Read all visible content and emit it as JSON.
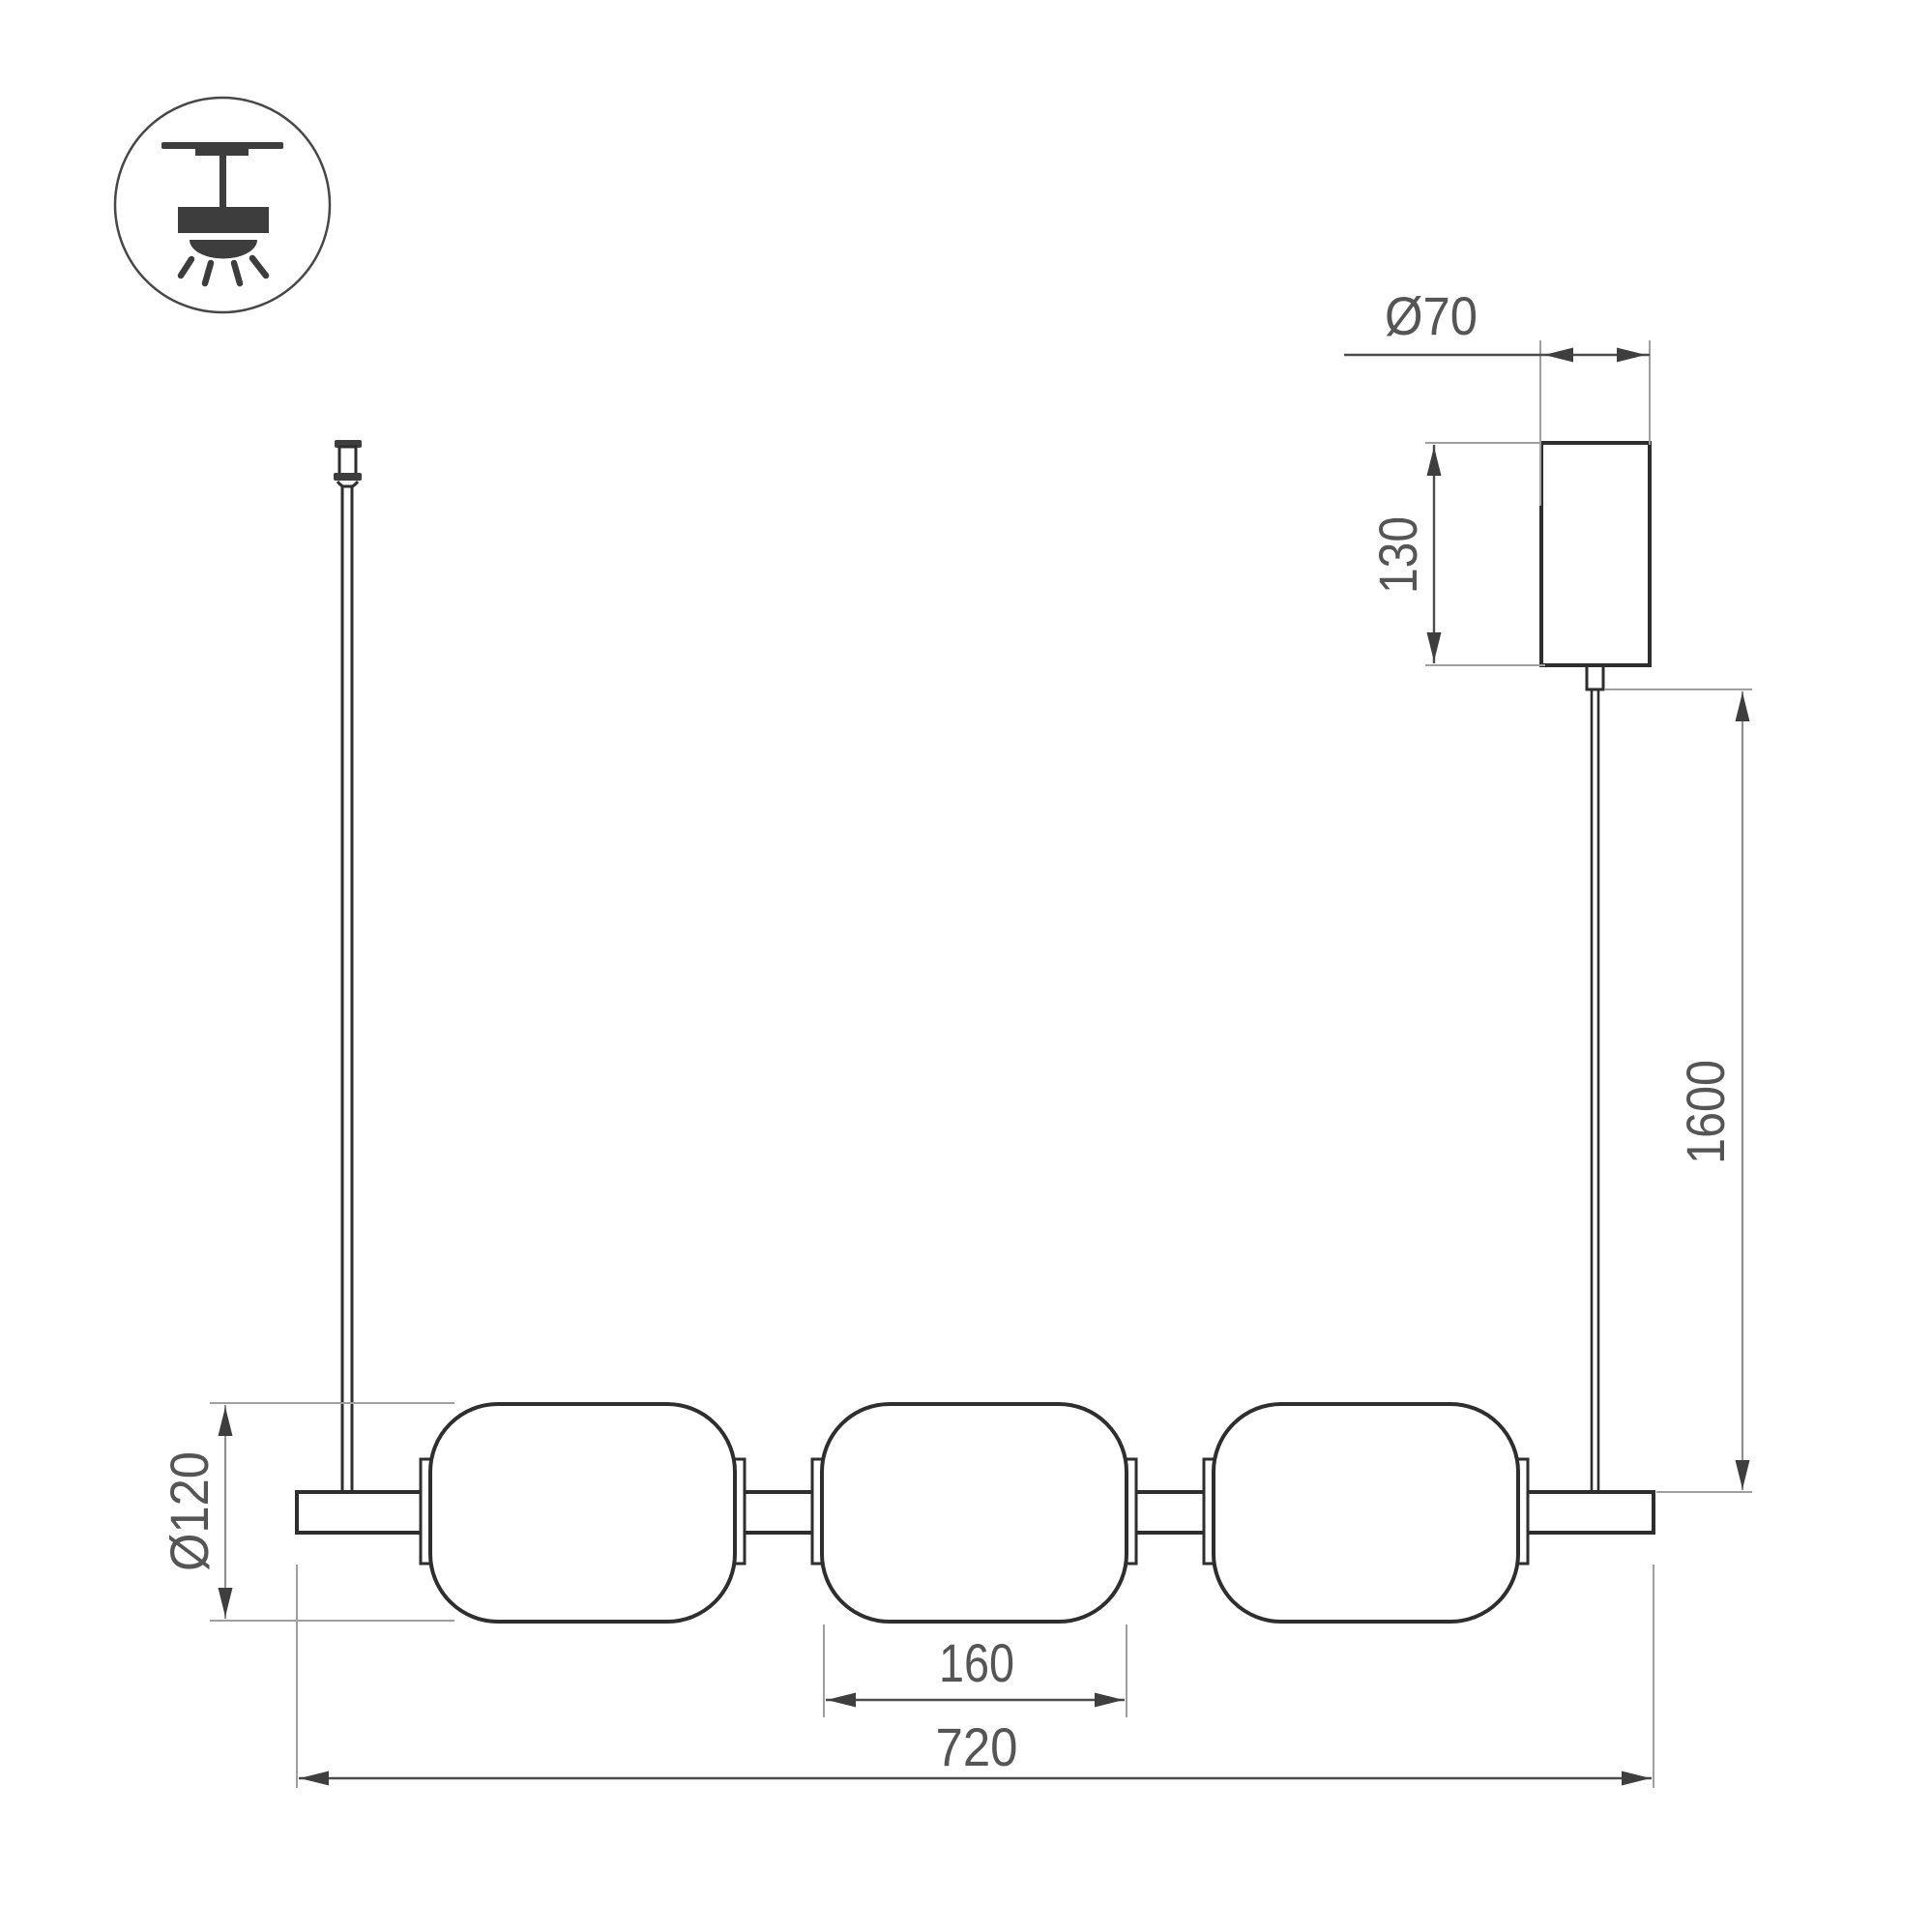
{
  "labels": {
    "canopy_diameter": "Ø70",
    "canopy_height": "130",
    "suspension_height": "1600",
    "shade_diameter": "Ø120",
    "shade_width": "160",
    "fixture_width": "720"
  },
  "icon": {
    "name": "ceiling-pendant-light-icon"
  },
  "colors": {
    "background": "#ffffff",
    "outline": "#2e2e2e",
    "icon_fill": "#3d3d3d",
    "extension_line": "#9f9f9f",
    "dimension_line_dark": "#4c4c4c",
    "dimension_line_gray": "#8f8f8f",
    "arrowhead": "#3e3e3e",
    "text": "#555555"
  }
}
